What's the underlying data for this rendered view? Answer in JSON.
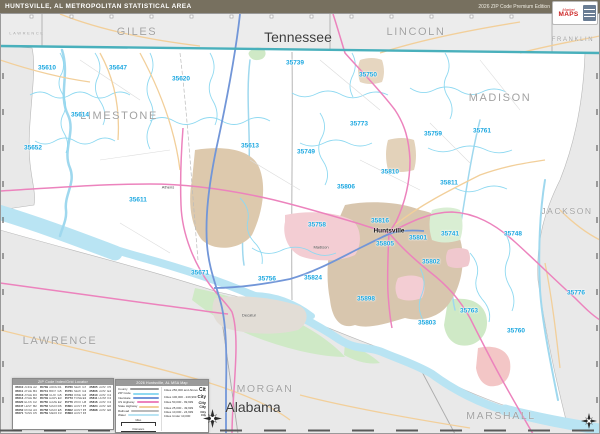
{
  "header": {
    "title": "HUNTSVILLE, AL METROPOLITAN STATISTICAL AREA",
    "edition": "2026 ZIP Code Premium Edition",
    "logo": {
      "line1": "Market",
      "line2": "MAPS"
    }
  },
  "map": {
    "state_labels": [
      {
        "text": "Tennessee",
        "x": 298,
        "y": 37,
        "size": 14
      },
      {
        "text": "Alabama",
        "x": 253,
        "y": 407,
        "size": 14
      }
    ],
    "county_labels": [
      {
        "text": "LAWRENCE",
        "key": "lawrence-tn",
        "x": 27,
        "y": 33,
        "size": 4
      },
      {
        "text": "GILES",
        "key": "giles",
        "x": 137,
        "y": 32,
        "size": 11
      },
      {
        "text": "LINCOLN",
        "key": "lincoln",
        "x": 416,
        "y": 32,
        "size": 11
      },
      {
        "text": "FRANKLIN",
        "key": "franklin",
        "x": 573,
        "y": 40,
        "size": 6
      },
      {
        "text": "LIMESTONE",
        "key": "limestone",
        "x": 119,
        "y": 116,
        "size": 11
      },
      {
        "text": "MADISON",
        "key": "madison",
        "x": 500,
        "y": 98,
        "size": 11
      },
      {
        "text": "JACKSON",
        "key": "jackson",
        "x": 567,
        "y": 211,
        "size": 8.5
      },
      {
        "text": "LAWRENCE",
        "key": "lawrence-al",
        "x": 60,
        "y": 341,
        "size": 11
      },
      {
        "text": "MORGAN",
        "key": "morgan",
        "x": 265,
        "y": 389,
        "size": 10.5
      },
      {
        "text": "MARSHALL",
        "key": "marshall",
        "x": 501,
        "y": 416,
        "size": 10.5
      }
    ],
    "zip_labels": [
      {
        "text": "35610",
        "x": 47,
        "y": 68
      },
      {
        "text": "35647",
        "x": 118,
        "y": 68
      },
      {
        "text": "35620",
        "x": 181,
        "y": 79
      },
      {
        "text": "35614",
        "x": 80,
        "y": 115
      },
      {
        "text": "35652",
        "x": 33,
        "y": 148
      },
      {
        "text": "35611",
        "x": 138,
        "y": 200
      },
      {
        "text": "35613",
        "x": 250,
        "y": 146
      },
      {
        "text": "35671",
        "x": 200,
        "y": 273
      },
      {
        "text": "35739",
        "x": 295,
        "y": 63
      },
      {
        "text": "35750",
        "x": 368,
        "y": 75
      },
      {
        "text": "35773",
        "x": 359,
        "y": 124
      },
      {
        "text": "35749",
        "x": 306,
        "y": 152
      },
      {
        "text": "35759",
        "x": 433,
        "y": 134
      },
      {
        "text": "35761",
        "x": 482,
        "y": 131
      },
      {
        "text": "35810",
        "x": 390,
        "y": 172
      },
      {
        "text": "35811",
        "x": 449,
        "y": 183
      },
      {
        "text": "35806",
        "x": 346,
        "y": 187
      },
      {
        "text": "35758",
        "x": 317,
        "y": 225
      },
      {
        "text": "35816",
        "x": 380,
        "y": 221
      },
      {
        "text": "35801",
        "x": 418,
        "y": 238
      },
      {
        "text": "35741",
        "x": 450,
        "y": 234
      },
      {
        "text": "35748",
        "x": 513,
        "y": 234
      },
      {
        "text": "35805",
        "x": 385,
        "y": 244
      },
      {
        "text": "35802",
        "x": 431,
        "y": 262
      },
      {
        "text": "35824",
        "x": 313,
        "y": 278
      },
      {
        "text": "35756",
        "x": 267,
        "y": 279
      },
      {
        "text": "35898",
        "x": 366,
        "y": 299
      },
      {
        "text": "35763",
        "x": 469,
        "y": 311
      },
      {
        "text": "35803",
        "x": 427,
        "y": 323
      },
      {
        "text": "35760",
        "x": 516,
        "y": 331
      },
      {
        "text": "35776",
        "x": 576,
        "y": 293
      }
    ],
    "city_labels": [
      {
        "text": "Athens",
        "x": 168,
        "y": 187,
        "bold": false
      },
      {
        "text": "Huntsville",
        "x": 389,
        "y": 231,
        "bold": true
      },
      {
        "text": "Madison",
        "x": 321,
        "y": 247,
        "bold": false
      },
      {
        "text": "Decatur",
        "x": 249,
        "y": 315,
        "bold": false
      }
    ]
  },
  "legend_index": {
    "title": "ZIP Code Index/Grid Locator",
    "rows": [
      [
        "35610",
        "ANDERSON",
        "A2"
      ],
      [
        "35611",
        "ATHENS",
        "B4"
      ],
      [
        "35613",
        "ATHENS",
        "D3"
      ],
      [
        "35614",
        "ATHENS",
        "B2"
      ],
      [
        "35620",
        "ELKMONT",
        "C2"
      ],
      [
        "35647",
        "LESTER",
        "B2"
      ],
      [
        "35652",
        "ROGERSVILLE",
        "A3"
      ],
      [
        "35671",
        "TANNER",
        "C5"
      ],
      [
        "35739",
        "ARDMORE",
        "D1"
      ],
      [
        "35741",
        "BROWNSBORO",
        "G5"
      ],
      [
        "35748",
        "GURLEY",
        "G5"
      ],
      [
        "35749",
        "HARVEST",
        "E3"
      ],
      [
        "35750",
        "HAZEL GREEN",
        "E2"
      ],
      [
        "35756",
        "MADISON",
        "D6"
      ],
      [
        "35758",
        "MADISON",
        "E5"
      ],
      [
        "35759",
        "MERIDIANVILLE",
        "F3"
      ],
      [
        "35760",
        "NEW HOPE",
        "G7"
      ],
      [
        "35761",
        "NEW MARKET",
        "G3"
      ],
      [
        "35763",
        "OWENS X RDS",
        "G6"
      ],
      [
        "35773",
        "TONEY",
        "E3"
      ],
      [
        "35776",
        "WOODVILLE",
        "H6"
      ],
      [
        "35801",
        "HUNTSVILLE",
        "F5"
      ],
      [
        "35802",
        "HUNTSVILLE",
        "F5"
      ],
      [
        "35803",
        "HUNTSVILLE",
        "F6"
      ],
      [
        "35805",
        "HUNTSVILLE",
        "F5"
      ],
      [
        "35806",
        "HUNTSVILLE",
        "E4"
      ],
      [
        "35810",
        "HUNTSVILLE",
        "F4"
      ],
      [
        "35811",
        "HUNTSVILLE",
        "F4"
      ],
      [
        "35816",
        "HUNTSVILLE",
        "F4"
      ],
      [
        "35824",
        "HUNTSVILLE",
        "E6"
      ],
      [
        "35898",
        "HUNTSVILLE",
        "E6"
      ],
      [
        "",
        "",
        ""
      ]
    ]
  },
  "legend_key": {
    "title": "2026 Huntsville, AL MSA Map",
    "line_items": [
      {
        "label": "County",
        "color": "#9a9a9a"
      },
      {
        "label": "ZIP Code",
        "color": "#8fd9f1"
      },
      {
        "label": "Interstate",
        "color": "#7296d8"
      },
      {
        "label": "US Highway",
        "color": "#ec83bd"
      },
      {
        "label": "State Highway",
        "color": "#f2cf9a"
      },
      {
        "label": "Railroad",
        "color": "#bbbbbb"
      },
      {
        "label": "Water",
        "color": "#b9e4f3"
      }
    ],
    "city_items": [
      "Cities 250,000 and Above",
      "Cities 100,000 - 249,999",
      "Cities 50,000 - 99,999",
      "Cities 25,000 - 49,999",
      "Cities 10,000 - 24,999",
      "Cities Under 10,000"
    ],
    "city_sample": "City",
    "scales": [
      "Miles",
      "Kilometers"
    ]
  },
  "colors": {
    "header_bg": "#77705f",
    "zip_label": "#1ba7e0",
    "state_line": "#49b0bc",
    "water": "#b9e4f3",
    "urban_tan": "#ddc9ad",
    "urban_pink": "#f3cdd3",
    "nonmsa_gray": "#e9e9e9"
  }
}
